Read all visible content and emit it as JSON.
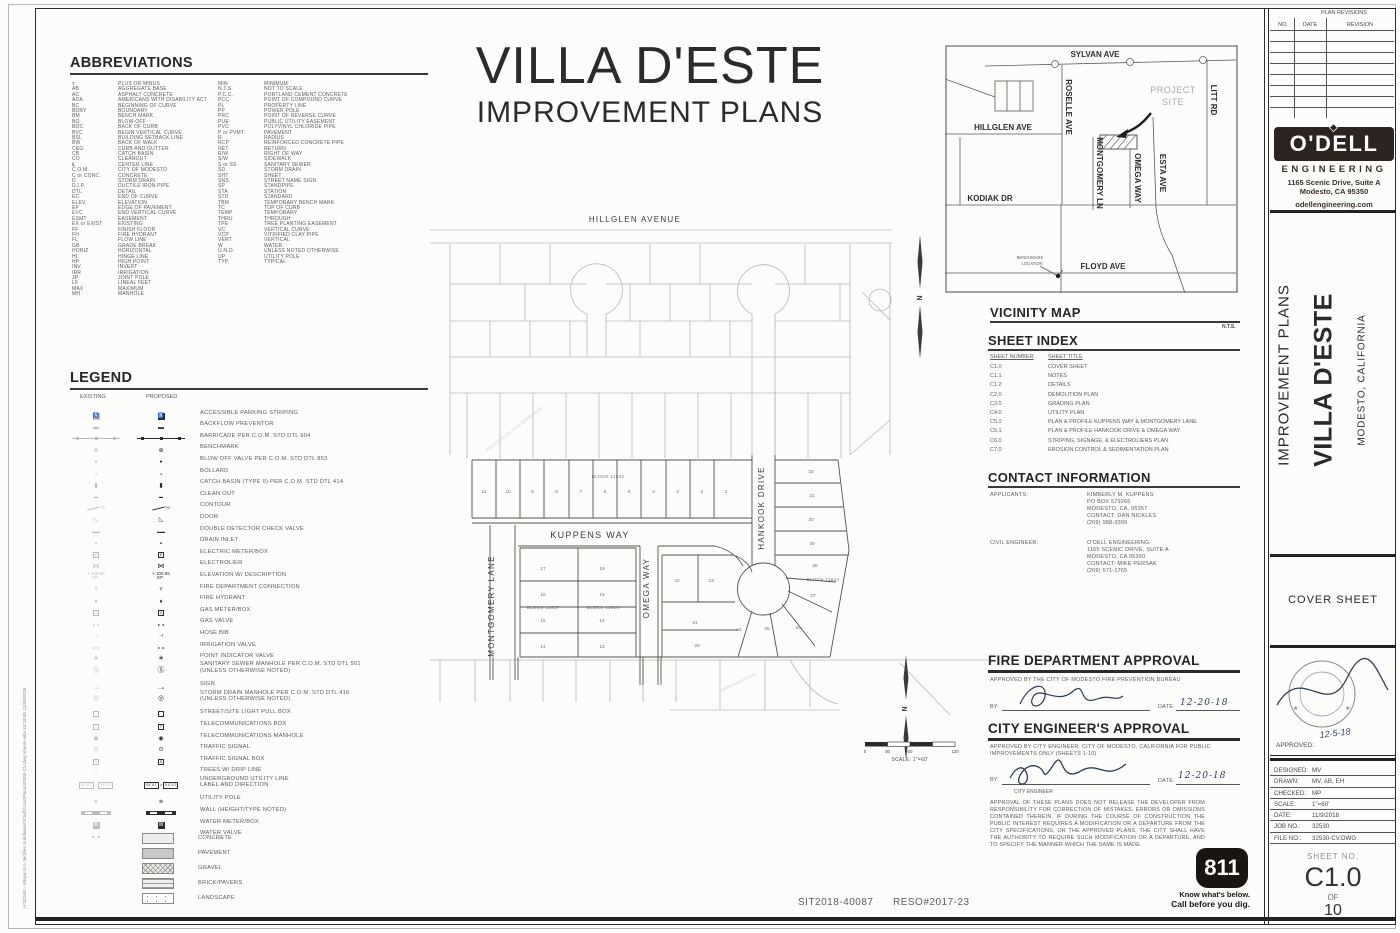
{
  "title": {
    "project": "VILLA D'ESTE",
    "subtitle": "IMPROVEMENT PLANS"
  },
  "abbreviations": {
    "heading": "ABBREVIATIONS",
    "col1": [
      [
        "±",
        "PLUS OR MINUS"
      ],
      [
        "AB",
        "AGGREGATE BASE"
      ],
      [
        "AC",
        "ASPHALT CONCRETE"
      ],
      [
        "ADA",
        "AMERICANS WITH DISABILITY ACT"
      ],
      [
        "BC",
        "BEGINNING OF CURVE"
      ],
      [
        "BDRY",
        "BOUNDARY"
      ],
      [
        "BM",
        "BENCH MARK"
      ],
      [
        "BO",
        "BLOW-OFF"
      ],
      [
        "BOC",
        "BACK OF CURB"
      ],
      [
        "BVC",
        "BEGIN VERTICAL CURVE"
      ],
      [
        "BSL",
        "BUILDING SETBACK LINE"
      ],
      [
        "BW",
        "BACK OF WALK"
      ],
      [
        "C&G",
        "CURB AND GUTTER"
      ],
      [
        "CB",
        "CATCH BASIN"
      ],
      [
        "CO",
        "CLEANOUT"
      ],
      [
        "℄",
        "CENTER LINE"
      ],
      [
        "C.O.M.",
        "CITY OF MODESTO"
      ],
      [
        "C or CONC.",
        "CONCRETE"
      ],
      [
        "D",
        "STORM DRAIN"
      ],
      [
        "D.I.P.",
        "DUCTILE IRON PIPE"
      ],
      [
        "DTL",
        "DETAIL"
      ],
      [
        "EC",
        "END OF CURVE"
      ],
      [
        "ELEV.",
        "ELEVATION"
      ],
      [
        "EP",
        "EDGE OF PAVEMENT"
      ],
      [
        "EVC",
        "END VERTICAL CURVE"
      ],
      [
        "ESMT",
        "EASEMENT"
      ],
      [
        "EX or EXIST",
        "EXISTING"
      ],
      [
        "FF",
        "FINISH FLOOR"
      ],
      [
        "FH",
        "FIRE HYDRANT"
      ],
      [
        "FL",
        "FLOW LINE"
      ],
      [
        "GB",
        "GRADE BREAK"
      ],
      [
        "HORIZ",
        "HORIZONTAL"
      ],
      [
        "HL",
        "HINGE LINE"
      ],
      [
        "HP",
        "HIGH POINT"
      ],
      [
        "INV.",
        "INVERT"
      ],
      [
        "IRR",
        "IRRIGATION"
      ],
      [
        "JP",
        "JOINT POLE"
      ],
      [
        "LF",
        "LINEAL FEET"
      ],
      [
        "MAX",
        "MAXIMUM"
      ],
      [
        "MH",
        "MANHOLE"
      ]
    ],
    "col2": [
      [
        "MIN",
        "MINIMUM"
      ],
      [
        "N.T.S.",
        "NOT TO SCALE"
      ],
      [
        "P.C.C.",
        "PORTLAND CEMENT CONCRETE"
      ],
      [
        "PCC",
        "POINT OF COMPOUND CURVE"
      ],
      [
        "PL",
        "PROPERTY LINE"
      ],
      [
        "PP",
        "POWER POLE"
      ],
      [
        "PRC",
        "POINT OF REVERSE CURVE"
      ],
      [
        "PUE",
        "PUBLIC UTILITY EASEMENT"
      ],
      [
        "PVC",
        "POLYVINYL CHLORIDE PIPE"
      ],
      [
        "P or PVMT",
        "PAVEMENT"
      ],
      [
        "R",
        "RADIUS"
      ],
      [
        "RCP",
        "REINFORCED CONCRETE PIPE"
      ],
      [
        "RET",
        "RETURN"
      ],
      [
        "R/W",
        "RIGHT OF WAY"
      ],
      [
        "S/W",
        "SIDEWALK"
      ],
      [
        "S or SS",
        "SANITARY SEWER"
      ],
      [
        "SD",
        "STORM DRAIN"
      ],
      [
        "SHT",
        "SHEET"
      ],
      [
        "SNS",
        "STREET NAME SIGN"
      ],
      [
        "SP",
        "STANDPIPE"
      ],
      [
        "STA",
        "STATION"
      ],
      [
        "STD",
        "STANDARD"
      ],
      [
        "TBM",
        "TEMPORARY BENCH MARK"
      ],
      [
        "TC",
        "TOP OF CURB"
      ],
      [
        "TEMP",
        "TEMPORARY"
      ],
      [
        "THRU",
        "THROUGH"
      ],
      [
        "TPE",
        "TREE PLANTING EASEMENT"
      ],
      [
        "VC",
        "VERTICAL CURVE"
      ],
      [
        "VCP",
        "VITRIFIED CLAY PIPE"
      ],
      [
        "VERT",
        "VERTICAL"
      ],
      [
        "W",
        "WATER"
      ],
      [
        "U.N.O.",
        "UNLESS NOTED OTHERWISE"
      ],
      [
        "UP",
        "UTILITY POLE"
      ],
      [
        "TYP.",
        "TYPICAL"
      ]
    ]
  },
  "legend": {
    "heading": "LEGEND",
    "existing_label": "EXISTING",
    "proposed_label": "PROPOSED",
    "contour_num": "70",
    "elev_text": "100.65",
    "elev_sub": "EP",
    "ut_text": "XX\"UT",
    "items": [
      {
        "icon": "accessible",
        "label": "ACCESSIBLE PARKING STRIPING"
      },
      {
        "icon": "backflow",
        "label": "BACKFLOW PREVENTOR"
      },
      {
        "icon": "barricade",
        "label": "BARRICADE PER C.O.M. STD DTL 904"
      },
      {
        "icon": "benchmark",
        "label": "BENCHMARK"
      },
      {
        "icon": "blowoff",
        "label": "BLOW OFF VALVE PER C.O.M. STD DTL 853"
      },
      {
        "icon": "bollard",
        "label": "BOLLARD"
      },
      {
        "icon": "catchbasin",
        "label": "CATCH BASIN (TYPE II) PER C.O.M. STD DTL 414"
      },
      {
        "icon": "cleanout",
        "label": "CLEAN OUT"
      },
      {
        "icon": "contour",
        "label": "CONTOUR"
      },
      {
        "icon": "door",
        "label": "DOOR"
      },
      {
        "icon": "ddcv",
        "label": "DOUBLE DETECTOR CHECK VALVE"
      },
      {
        "icon": "draininlet",
        "label": "DRAIN INLET"
      },
      {
        "icon": "electricmeter",
        "label": "ELECTRIC METER/BOX"
      },
      {
        "icon": "electrolier",
        "label": "ELECTROLIER"
      },
      {
        "icon": "elevation",
        "label": "ELEVATION W/ DESCRIPTION"
      },
      {
        "icon": "fdc",
        "label": "FIRE DEPARTMENT CONNECTION"
      },
      {
        "icon": "hydrant",
        "label": "FIRE HYDRANT"
      },
      {
        "icon": "gasmeter",
        "label": "GAS METER/BOX"
      },
      {
        "icon": "gasvalve",
        "label": "GAS VALVE"
      },
      {
        "icon": "hosebib",
        "label": "HOSE BIB"
      },
      {
        "icon": "irrvalve",
        "label": "IRRIGATION VALVE"
      },
      {
        "icon": "piv",
        "label": "POINT INDICATOR VALVE"
      },
      {
        "icon": "ssmh",
        "label": "SANITARY SEWER MANHOLE PER C.O.M. STD DTL 501",
        "label2": "(UNLESS OTHERWISE NOTED)"
      },
      {
        "icon": "sign",
        "label": "SIGN"
      },
      {
        "icon": "sdmh",
        "label": "STORM DRAIN MANHOLE PER C.O.M. STD DTL 416",
        "label2": "(UNLESS OTHERWISE NOTED)"
      },
      {
        "icon": "pullbox",
        "label": "STREET/SITE LIGHT PULL BOX"
      },
      {
        "icon": "telecombox",
        "label": "TELECOMMUNICATIONS BOX"
      },
      {
        "icon": "telecommh",
        "label": "TELECOMMUNICATIONS MANHOLE"
      },
      {
        "icon": "signal",
        "label": "TRAFFIC SIGNAL"
      },
      {
        "icon": "signalbox",
        "label": "TRAFFIC SIGNAL BOX"
      },
      {
        "icon": "trees",
        "label": "TREES W/ DRIP LINE",
        "existing_only": true
      },
      {
        "icon": "utlabel",
        "label": "UNDERGROUND UTILITY LINE",
        "label2": "LABEL AND DIRECTION"
      },
      {
        "icon": "utilitypole",
        "label": "UTILITY POLE"
      },
      {
        "icon": "wall",
        "label": "WALL (HEIGHT/TYPE NOTED)"
      },
      {
        "icon": "watermeter",
        "label": "WATER METER/BOX"
      },
      {
        "icon": "watervalve",
        "label": "WATER VALVE"
      }
    ],
    "swatches": [
      {
        "key": "concrete",
        "label": "CONCRETE"
      },
      {
        "key": "pavement",
        "label": "PAVEMENT"
      },
      {
        "key": "gravel",
        "label": "GRAVEL"
      },
      {
        "key": "brick",
        "label": "BRICK/PAVERS"
      },
      {
        "key": "landscape",
        "label": "LANDSCAPE"
      }
    ]
  },
  "site_plan": {
    "hillglen": "HILLGLEN AVENUE",
    "kuppens": "KUPPENS WAY",
    "montgomery": "MONTGOMERY LANE",
    "omega": "OMEGA WAY",
    "hankook": "HANKOOK DRIVE",
    "block_11622": "BLOCK 11622",
    "block_11617": "BLOCK 11617",
    "block_11616": "BLOCK 11616",
    "block_11614": "BLOCK 11614",
    "block_11622_lots": [
      "11",
      "10",
      "9",
      "8",
      "7",
      "6",
      "5",
      "4",
      "3",
      "2",
      "1"
    ],
    "block_11617_lots": [
      "17",
      "16",
      "15",
      "14"
    ],
    "block_11616_lots": [
      "16",
      "15",
      "14",
      "13"
    ],
    "misc_lots": [
      "22",
      "23",
      "21",
      "20",
      "24",
      "25",
      "26",
      "27",
      "28",
      "29",
      "30",
      "31",
      "32"
    ],
    "faint_north": "PROPOSED HILLGLEN SUBDIVISION",
    "faint_south": "LAURA SUBDIVISION",
    "north_label": "N"
  },
  "scale_bar": {
    "t0": "0",
    "t1": "30",
    "t2": "60",
    "t3": "120",
    "label": "SCALE: 1\"=60'"
  },
  "vicinity": {
    "heading": "VICINITY MAP",
    "nts": "N.T.S.",
    "sylvan": "SYLVAN AVE",
    "roselle": "ROSELLE AVE",
    "hillglen": "HILLGLEN AVE",
    "montgomery": "MONTGOMERY LN",
    "omega": "OMEGA WAY",
    "esta": "ESTA AVE",
    "litt": "LITT RD",
    "kodiak": "KODIAK DR",
    "floyd": "FLOYD AVE",
    "project_line1": "PROJECT",
    "project_line2": "SITE",
    "benchmark_line1": "BENCHMARK",
    "benchmark_line2": "LOCATION"
  },
  "sheet_index": {
    "heading": "SHEET INDEX",
    "col_number": "SHEET NUMBER",
    "col_title": "SHEET TITLE",
    "rows": [
      [
        "C1.0",
        "COVER SHEET"
      ],
      [
        "C1.1",
        "NOTES"
      ],
      [
        "C1.2",
        "DETAILS"
      ],
      [
        "C2.0",
        "DEMOLITION PLAN"
      ],
      [
        "C3.0",
        "GRADING PLAN"
      ],
      [
        "C4.0",
        "UTILITY PLAN"
      ],
      [
        "C5.0",
        "PLAN & PROFILE KUPPENS WAY & MONTGOMERY LANE"
      ],
      [
        "C5.1",
        "PLAN & PROFILE HANKOOK DRIVE & OMEGA WAY"
      ],
      [
        "C6.0",
        "STRIPING, SIGNAGE, & ELECTROLIERS PLAN"
      ],
      [
        "C7.0",
        "EROSION CONTROL & SEDIMENTATION PLAN"
      ]
    ]
  },
  "contact": {
    "heading": "CONTACT INFORMATION",
    "applicants_label": "APPLICANTS:",
    "applicants": [
      "KIMBERLY M. KUPPENS",
      "PO BOX 579266",
      "MODESTO, CA, 95357",
      "CONTACT: DAN NICKLES",
      "(209) 988-3399"
    ],
    "engineer_label": "CIVIL ENGINEER:",
    "engineer": [
      "O'DELL ENGINEERING",
      "1165 SCENIC DRIVE, SUITE A",
      "MODESTO, CA  95350",
      "CONTACT: MIKE PERSAK",
      "(209) 571-1765"
    ]
  },
  "fire_approval": {
    "heading": "FIRE DEPARTMENT APPROVAL",
    "text": "APPROVED BY THE CITY OF MODESTO FIRE PREVENTION BUREAU",
    "by_label": "BY:",
    "date_label": "DATE:",
    "date": "12-20-18"
  },
  "city_approval": {
    "heading": "CITY ENGINEER'S APPROVAL",
    "text": "APPROVED BY CITY ENGINEER: CITY OF MODESTO, CALIFORNIA FOR PUBLIC IMPROVEMENTS ONLY (SHEETS 1-10)",
    "by_label": "BY:",
    "signer_title": "CITY ENGINEER",
    "date_label": "DATE:",
    "date": "12-20-18",
    "note": "APPROVAL OF THESE PLANS DOES NOT RELEASE THE DEVELOPER FROM RESPONSIBILITY FOR CORRECTION OF MISTAKES, ERRORS OR OMISSIONS CONTAINED THEREIN.  IF DURING THE COURSE OF CONSTRUCTION THE PUBLIC INTEREST REQUIRES A MODIFICATION OR A DEPARTURE FROM THE CITY SPECIFICATIONS, OR THE APPROVED PLANS, THE CITY SHALL HAVE THE AUTHORITY TO REQUIRE SUCH MODIFICATION OR A DEPARTURE, AND TO SPECIFY THE MANNER WHICH THE SAME IS MADE."
  },
  "call811": {
    "number": "811",
    "line1": "Know what's below.",
    "line2": "Call before you dig."
  },
  "revisions": {
    "title": "PLAN REVISIONS",
    "col_no": "NO.",
    "col_date": "DATE",
    "col_revision": "REVISION",
    "empty_rows": 7
  },
  "firm": {
    "name": "O'DELL",
    "sub": "ENGINEERING",
    "address1": "1165 Scenic Drive, Suite A",
    "address2": "Modesto, CA 95350",
    "website": "odellengineering.com"
  },
  "titleblock": {
    "improvement_plans": "IMPROVEMENT PLANS",
    "project": "VILLA D'ESTE",
    "location": "MODESTO, CALIFORNIA",
    "cover_sheet": "COVER SHEET",
    "approved_label": "APPROVED:",
    "stamp_date": "12-5-18",
    "rows": [
      [
        "DESIGNED:",
        "MV"
      ],
      [
        "DRAWN:",
        "MV, AB, EH"
      ],
      [
        "CHECKED:",
        "MP"
      ],
      [
        "SCALE:",
        "1\"=60'"
      ],
      [
        "DATE:",
        "11/9/2018"
      ],
      [
        "JOB NO.:",
        "32530"
      ],
      [
        "FILE NO.:",
        "32530-CV.DWG"
      ]
    ],
    "sheet_no_label": "SHEET NO.",
    "sheet_no": "C1.0",
    "of_label": "OF",
    "sheet_total": "10"
  },
  "footer": {
    "sit": "SIT2018-40087",
    "reso": "RESO#2017-23",
    "path": "H:\\32530 - Wispa Grn. Nickles Subdivision\\Civil\\ConstPlans\\32530-CV.dwg   sheets-villa   15:28:05   12/05/2018"
  }
}
